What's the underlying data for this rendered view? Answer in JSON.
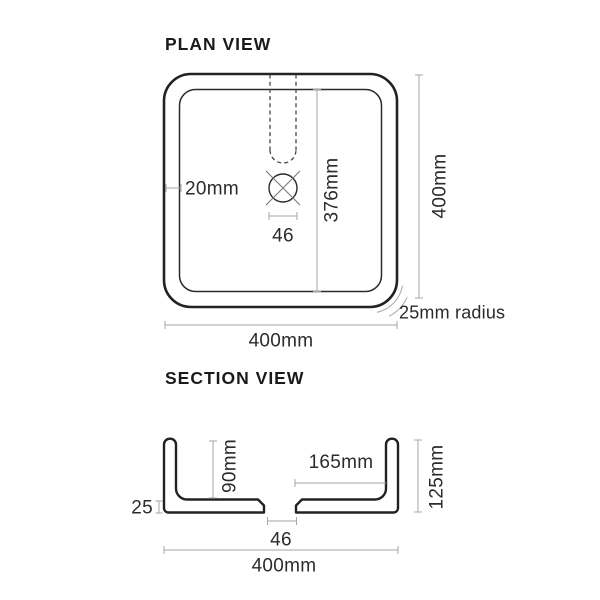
{
  "colors": {
    "background": "#ffffff",
    "object_line": "#222222",
    "dimension_line": "#a6a6a6",
    "label_text": "#2b2b2b",
    "title_text": "#1a1a1a"
  },
  "plan_view": {
    "title": "PLAN VIEW",
    "dim_wall_thickness": "20mm",
    "dim_basin_inner_length": "376mm",
    "dim_drain_width": "46",
    "dim_overall_height": "400mm",
    "dim_overall_width": "400mm",
    "dim_corner_radius": "25mm radius"
  },
  "section_view": {
    "title": "SECTION VIEW",
    "dim_inner_depth": "90mm",
    "dim_drain_to_wall": "165mm",
    "dim_overall_height": "125mm",
    "dim_base_thickness": "25",
    "dim_drain_width": "46",
    "dim_overall_width": "400mm"
  }
}
